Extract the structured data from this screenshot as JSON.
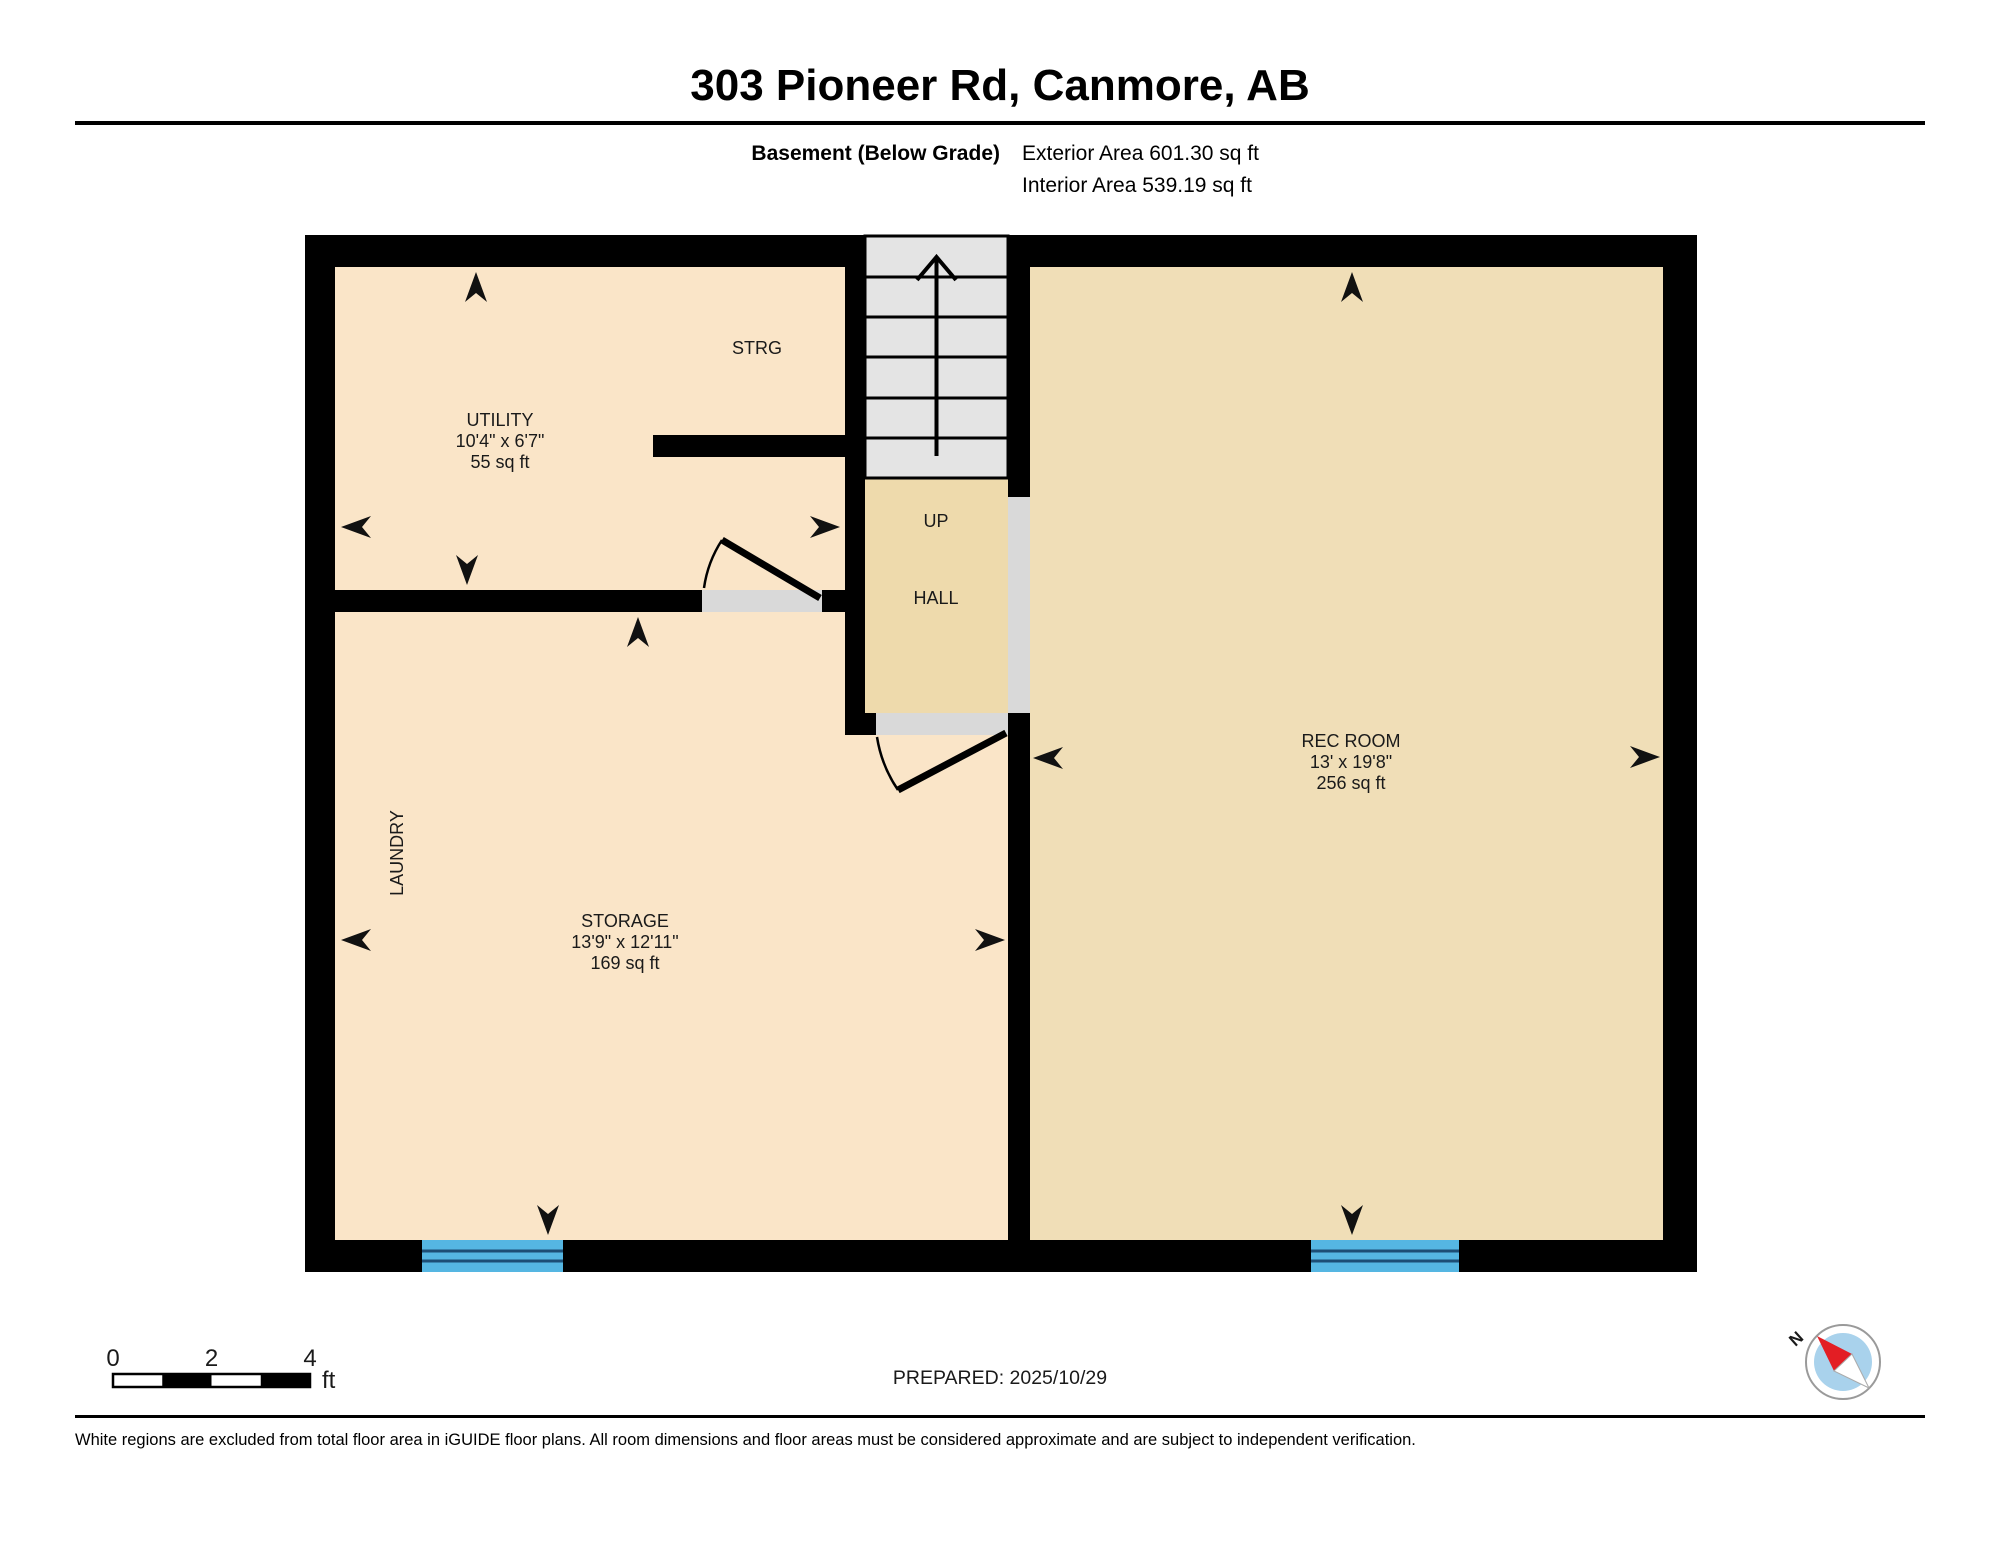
{
  "header": {
    "title": "303 Pioneer Rd, Canmore, AB",
    "floor_label": "Basement (Below Grade)",
    "exterior_area": "Exterior Area 601.30 sq ft",
    "interior_area": "Interior Area 539.19 sq ft"
  },
  "rooms": {
    "utility": {
      "name": "UTILITY",
      "dimensions": "10'4\" x 6'7\"",
      "area": "55 sq ft"
    },
    "strg": {
      "name": "STRG"
    },
    "hall": {
      "name": "HALL",
      "up_label": "UP"
    },
    "laundry": {
      "name": "LAUNDRY"
    },
    "storage": {
      "name": "STORAGE",
      "dimensions": "13'9\" x 12'11\"",
      "area": "169 sq ft"
    },
    "rec_room": {
      "name": "REC ROOM",
      "dimensions": "13' x 19'8\"",
      "area": "256 sq ft"
    }
  },
  "scale_bar": {
    "tick_0": "0",
    "tick_2": "2",
    "tick_4": "4",
    "unit": "ft"
  },
  "prepared_label": "PREPARED: 2025/10/29",
  "compass": {
    "north_label": "N"
  },
  "footer": {
    "disclaimer": "White regions are excluded from total floor area in iGUIDE floor plans. All room dimensions and floor areas must be considered approximate and are subject to independent verification."
  },
  "colors": {
    "wall": "#000000",
    "room_light": "#FAE5C8",
    "room_hall": "#EEDAAC",
    "room_rec": "#F0DEB7",
    "stairs": "#E4E4E4",
    "threshold": "#D9D9D9",
    "window_blue": "#55B6E2",
    "window_line": "#1D4E75",
    "compass_face": "#A9D2EC",
    "compass_needle": "#E31E24"
  }
}
